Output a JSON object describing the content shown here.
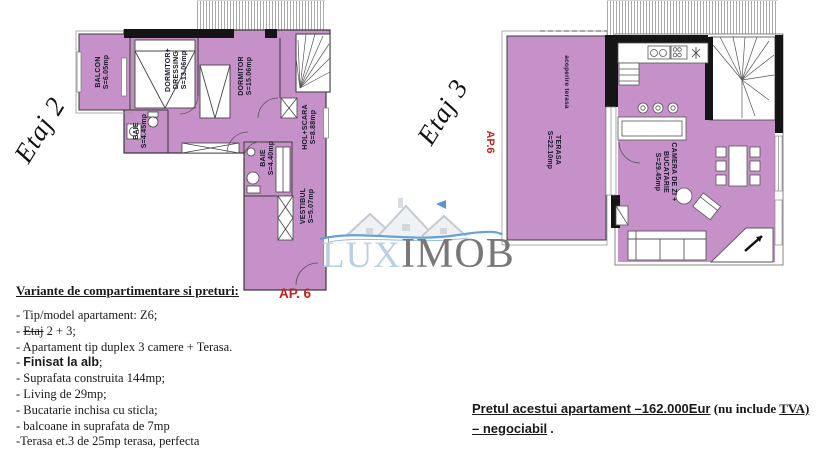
{
  "document": {
    "type": "apartment floor-plan offer sheet"
  },
  "colors": {
    "room_fill": "#c691c8",
    "accent_red": "#c3231c",
    "watermark_blue": "#5b9bd5",
    "watermark_lux": "#b6cde3",
    "watermark_gray": "#6e6e6e"
  },
  "plans": {
    "etaj2": {
      "floor_script": "Etaj 2",
      "ap_label": "AP. 6",
      "rooms": {
        "balcon": "BALCON\nS=6.05mp",
        "dormitor_dressing": "DORMITOR+\nDRESSING\nS=13.06mp",
        "dormitor": "DORMITOR\nS=15.06mp",
        "baie": "BAIE\nS=4.45mp",
        "hol_scara": "HOL+SCARA\nS=8.88mp",
        "baie2": "BAIE\nS=4.40mp",
        "vestibul": "VESTIBUL\nS=5.07mp"
      }
    },
    "etaj3": {
      "floor_script": "Etaj 3",
      "ap_label": "AP.6",
      "rooms": {
        "acoperire": "acoperire terasa",
        "terasa": "TERASA\nS=22.10mp",
        "camera_zi": "CAMERA DE ZI +\nBUCATARIE\nS=29.45mp"
      }
    }
  },
  "watermark": {
    "lux": "LUX",
    "imob": "IMOB"
  },
  "specs": {
    "heading": "Variante de compartimentare si preturi:",
    "lines": [
      {
        "segments": [
          {
            "t": "- Tip/model apartament: Z6;"
          }
        ]
      },
      {
        "segments": [
          {
            "t": "- "
          },
          {
            "t": "Etaj",
            "strike": true
          },
          {
            "t": " 2 + 3;"
          }
        ]
      },
      {
        "segments": [
          {
            "t": "- Apartament tip duplex 3 camere + Terasa."
          }
        ]
      },
      {
        "segments": [
          {
            "t": "- "
          },
          {
            "t": "Finisat la alb",
            "bold": true,
            "sans": true
          },
          {
            "t": ";"
          }
        ]
      },
      {
        "segments": [
          {
            "t": "- Suprafata construita 144mp;"
          }
        ]
      },
      {
        "segments": [
          {
            "t": "- Living de 29mp;"
          }
        ]
      },
      {
        "segments": [
          {
            "t": "- Bucatarie inchisa cu sticla;"
          }
        ]
      },
      {
        "segments": [
          {
            "t": "- balcoane in suprafata de  7mp"
          }
        ]
      },
      {
        "segments": [
          {
            "t": "-Terasa et.3 de 25mp terasa, perfecta"
          }
        ]
      }
    ]
  },
  "price": {
    "lines": [
      {
        "segments": [
          {
            "t": "Pretul  acestui apartament –162.000Eur",
            "u": true,
            "sans": true
          },
          {
            "t": " (nu include "
          },
          {
            "t": "TVA)",
            "u": true
          }
        ]
      },
      {
        "segments": [
          {
            "t": "– negociabil",
            "u": true,
            "sans": true
          },
          {
            "t": " ."
          }
        ]
      }
    ]
  }
}
